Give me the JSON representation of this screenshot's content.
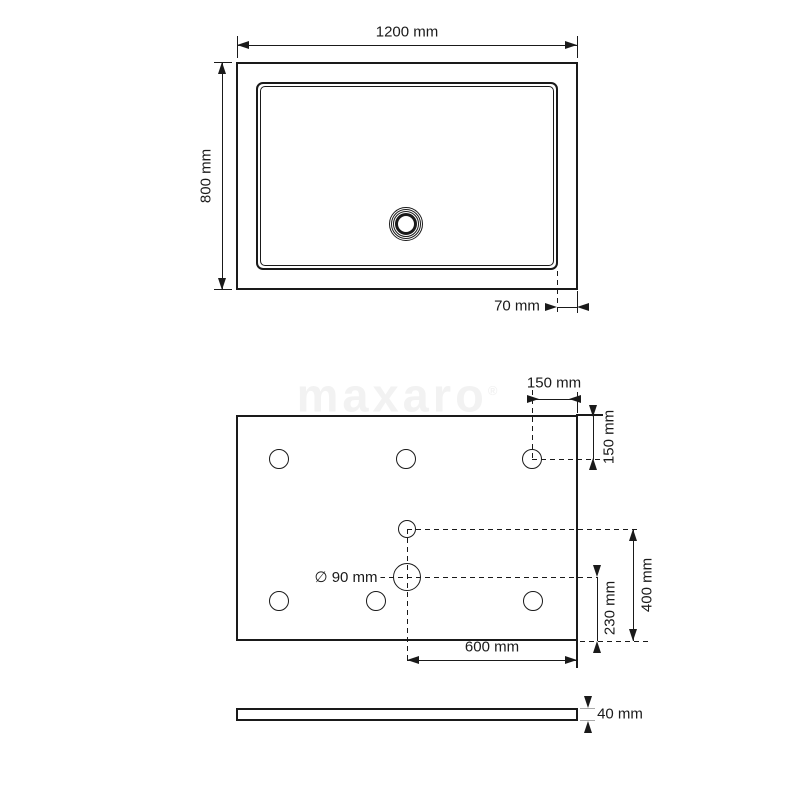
{
  "watermark": {
    "brand": "maxaro",
    "mark": "®"
  },
  "colors": {
    "line": "#1a1a1a",
    "background": "#ffffff",
    "watermark": "#f2f2f2"
  },
  "views": {
    "top": {
      "name": "top-view",
      "dims": {
        "width": "1200 mm",
        "height": "800 mm",
        "drain_edge_offset": "70 mm"
      }
    },
    "plan": {
      "name": "bottom-plan-view",
      "dims": {
        "hole_offset_x": "150 mm",
        "hole_offset_y": "150 mm",
        "center_to_bottom": "400 mm",
        "drain_to_bottom": "230 mm",
        "drain_to_right": "600 mm",
        "drain_diameter": "∅ 90 mm"
      }
    },
    "side": {
      "name": "side-view",
      "dims": {
        "thickness": "40 mm"
      }
    }
  }
}
